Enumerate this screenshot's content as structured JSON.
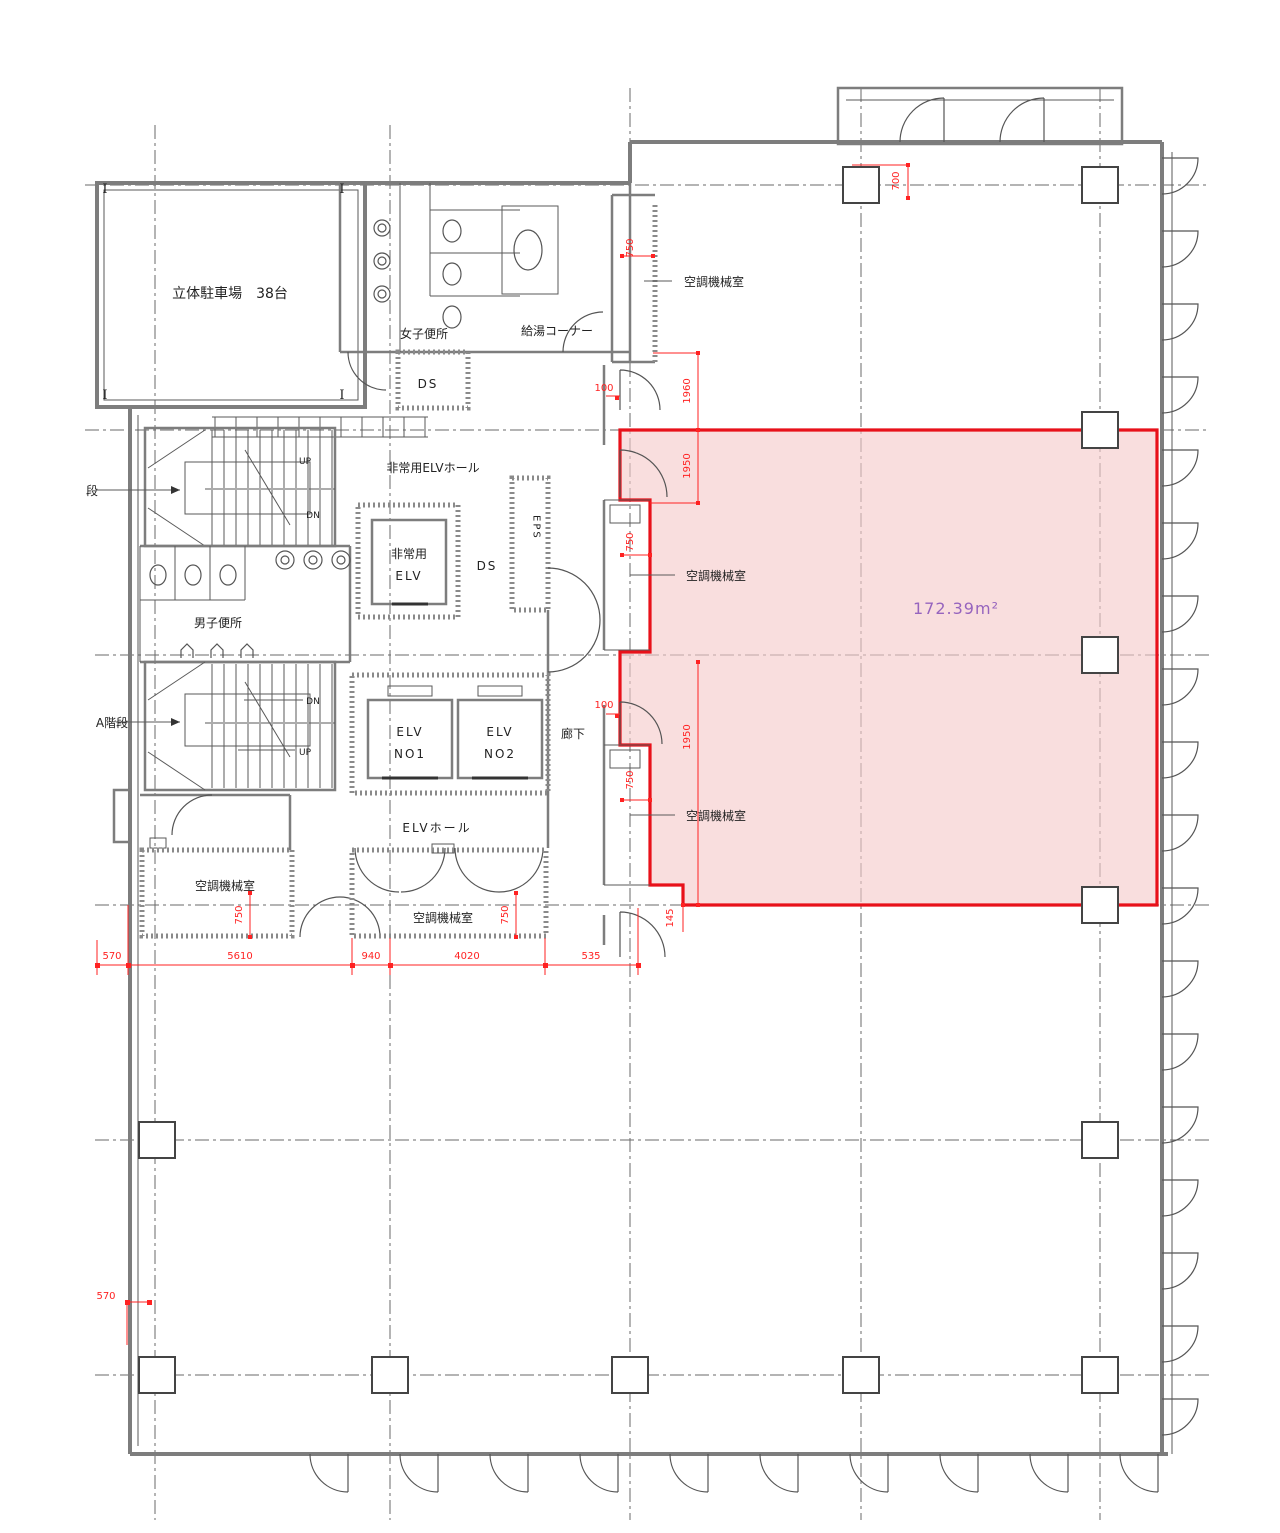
{
  "document": {
    "type": "architectural-floor-plan",
    "language": "ja"
  },
  "labels": {
    "parking": "立体駐車場　38台",
    "womens_toilet": "女子便所",
    "mens_toilet": "男子便所",
    "ds": "DS",
    "hot_water_corner": "給湯コーナー",
    "hvac_room": "空調機械室",
    "emergency_elv_hall": "非常用ELVホール",
    "emergency_elv_line1": "非常用",
    "emergency_elv_line2": "ELV",
    "eps": "EPS",
    "stair_partial": "段",
    "stair_a": "A階段",
    "elv": "ELV",
    "elv_no1": "NO1",
    "elv_no2": "NO2",
    "corridor": "廊下",
    "elv_hall": "ELVホール",
    "up": "UP",
    "down": "DN",
    "steel_mark": "I"
  },
  "highlight": {
    "area_label": "172.39m²",
    "fill": "#f6c9c9",
    "border": "#e8111a",
    "text_color": "#9664be"
  },
  "dimensions": {
    "top_750": "750",
    "top_100": "100",
    "v_1960": "1960",
    "v_1950_upper": "1950",
    "mid_750": "750",
    "mid_100": "100",
    "v_1950_lower": "1950",
    "low_750": "750",
    "corner_145": "145",
    "tr_700": "700",
    "bottom_570": "570",
    "bottom_5610": "5610",
    "bottom_940": "940",
    "bottom_4020": "4020",
    "bottom_535": "535",
    "left_570": "570",
    "room_750_left": "750",
    "room_750_right": "750"
  },
  "colors": {
    "wall": "#7d7d7d",
    "grid": "#6a6a6a",
    "dimension_red": "#ff2222"
  }
}
